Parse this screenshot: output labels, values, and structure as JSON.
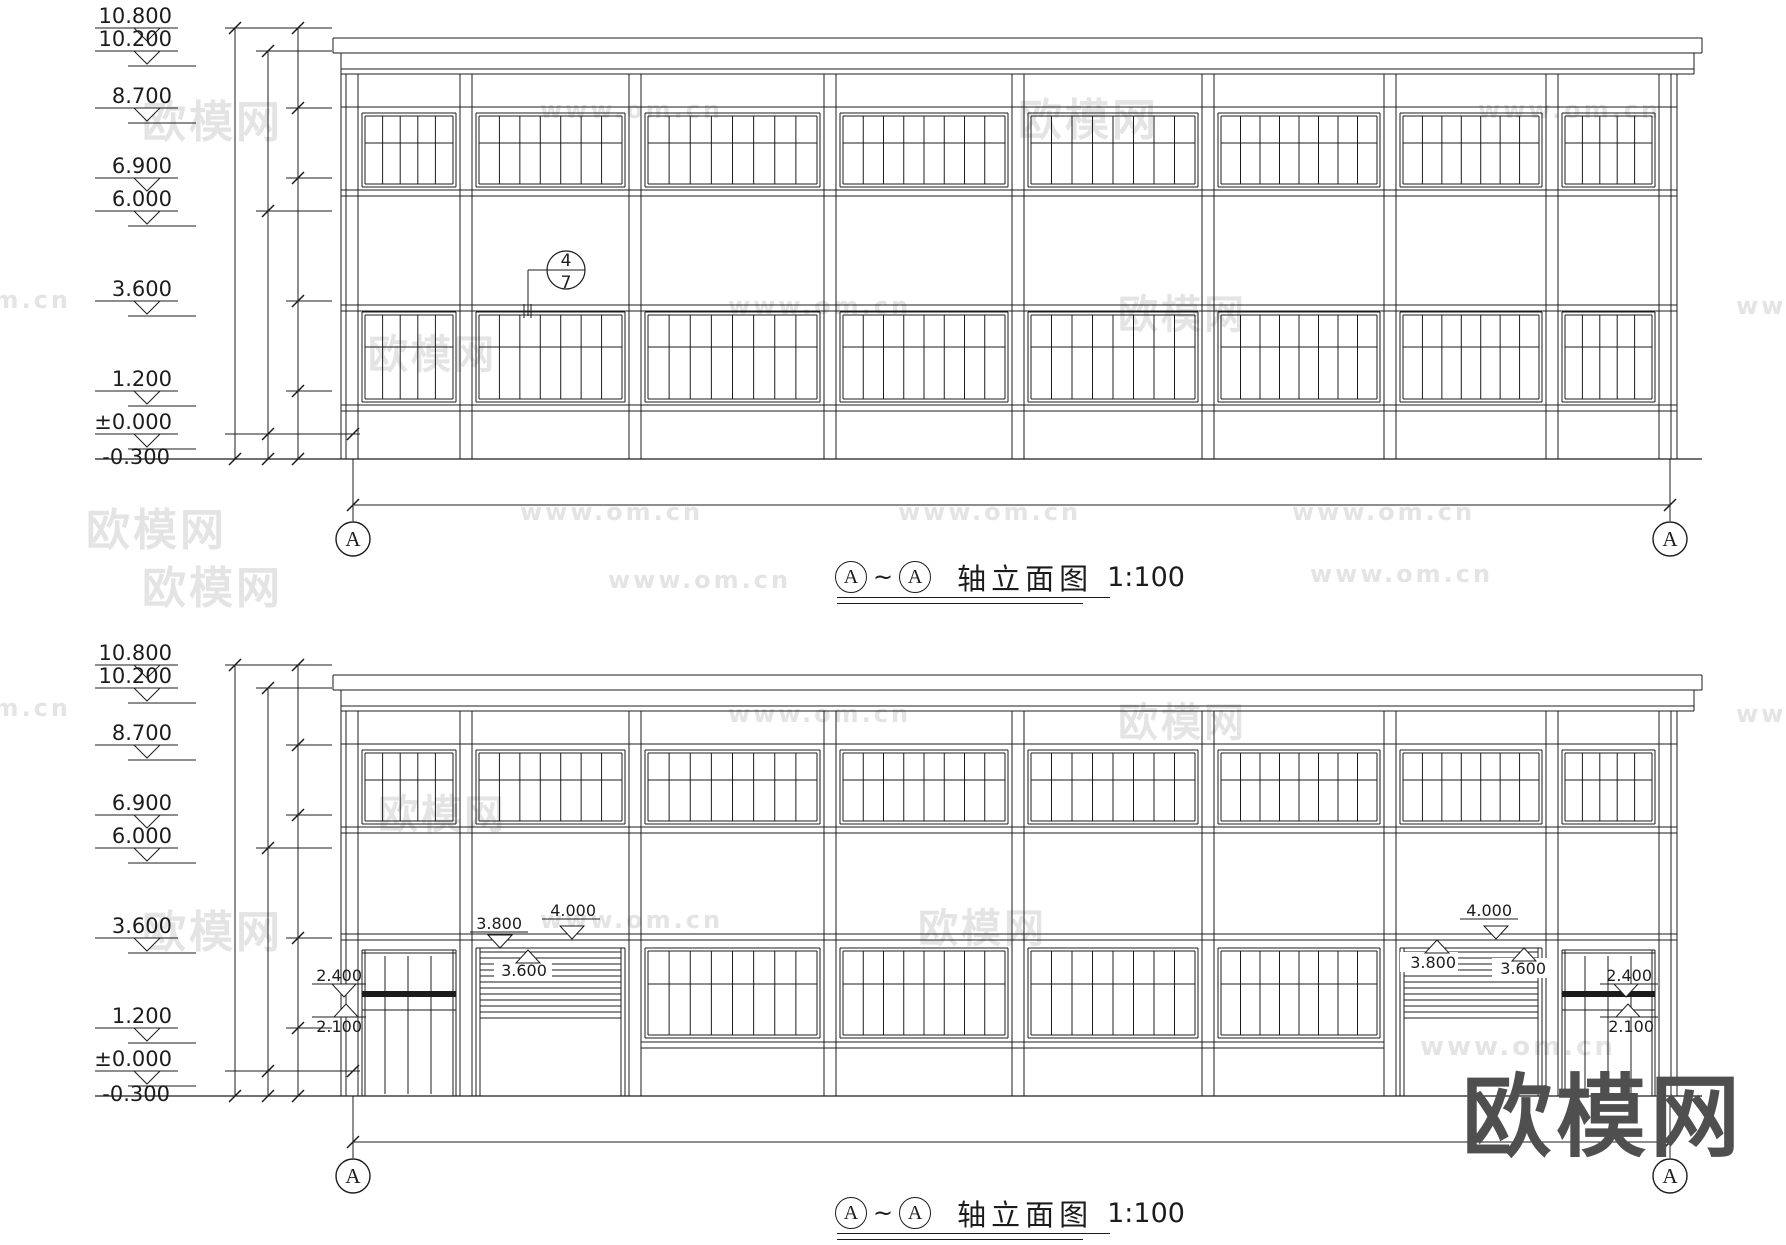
{
  "drawing": {
    "title_row": {
      "axis_a": "A",
      "separator": "~",
      "name": "轴立面图",
      "scale": "1:100"
    },
    "levels": [
      "10.800",
      "10.200",
      "8.700",
      "6.900",
      "6.000",
      "3.600",
      "1.200",
      "±0.000",
      "-0.300"
    ],
    "axis_bubble": "A",
    "detail_callout": {
      "top": "4",
      "bottom": "7"
    },
    "door_annotations": {
      "head": "2.400",
      "transom": "2.100"
    },
    "shutter_annotations": {
      "head": "3.800",
      "opening": "4.000",
      "curtain": "3.600"
    }
  },
  "watermarks": [
    {
      "text": "欧模网",
      "x": 142,
      "y": 86,
      "size": 44,
      "cls": "wm-light"
    },
    {
      "text": "www.om.cn",
      "x": 540,
      "y": 96,
      "size": 24,
      "cls": "wm-light"
    },
    {
      "text": "欧模网",
      "x": 1018,
      "y": 84,
      "size": 44,
      "cls": "wm-light"
    },
    {
      "text": "www.om.cn",
      "x": 1478,
      "y": 96,
      "size": 24,
      "cls": "wm-light"
    },
    {
      "text": "om.cn",
      "x": -26,
      "y": 286,
      "size": 24,
      "cls": "wm-light"
    },
    {
      "text": "欧模网",
      "x": 368,
      "y": 322,
      "size": 40,
      "cls": "wm-light"
    },
    {
      "text": "www.om.cn",
      "x": 728,
      "y": 292,
      "size": 24,
      "cls": "wm-light"
    },
    {
      "text": "欧模网",
      "x": 1118,
      "y": 282,
      "size": 40,
      "cls": "wm-light"
    },
    {
      "text": "www.",
      "x": 1736,
      "y": 292,
      "size": 24,
      "cls": "wm-light"
    },
    {
      "text": "欧模网",
      "x": 86,
      "y": 494,
      "size": 44,
      "cls": "wm-light"
    },
    {
      "text": "www.om.cn",
      "x": 520,
      "y": 498,
      "size": 24,
      "cls": "wm-light"
    },
    {
      "text": "www.om.cn",
      "x": 898,
      "y": 498,
      "size": 24,
      "cls": "wm-light"
    },
    {
      "text": "www.om.cn",
      "x": 1292,
      "y": 498,
      "size": 24,
      "cls": "wm-light"
    },
    {
      "text": "欧模网",
      "x": 142,
      "y": 552,
      "size": 44,
      "cls": "wm-light"
    },
    {
      "text": "www.om.cn",
      "x": 608,
      "y": 566,
      "size": 24,
      "cls": "wm-light"
    },
    {
      "text": "www.om.cn",
      "x": 1310,
      "y": 560,
      "size": 24,
      "cls": "wm-light"
    },
    {
      "text": "om.cn",
      "x": -26,
      "y": 694,
      "size": 24,
      "cls": "wm-light"
    },
    {
      "text": "www.om.cn",
      "x": 728,
      "y": 700,
      "size": 24,
      "cls": "wm-light"
    },
    {
      "text": "欧模网",
      "x": 1118,
      "y": 690,
      "size": 40,
      "cls": "wm-light"
    },
    {
      "text": "www.",
      "x": 1736,
      "y": 700,
      "size": 24,
      "cls": "wm-light"
    },
    {
      "text": "欧模网",
      "x": 378,
      "y": 782,
      "size": 40,
      "cls": "wm-light"
    },
    {
      "text": "欧模网",
      "x": 142,
      "y": 896,
      "size": 44,
      "cls": "wm-light"
    },
    {
      "text": "www.om.cn",
      "x": 540,
      "y": 906,
      "size": 24,
      "cls": "wm-light"
    },
    {
      "text": "欧模网",
      "x": 918,
      "y": 896,
      "size": 40,
      "cls": "wm-light"
    },
    {
      "text": "www.om.cn",
      "x": 1420,
      "y": 1032,
      "size": 26,
      "cls": "wm-light"
    },
    {
      "text": "欧模网",
      "x": 1462,
      "y": 1044,
      "size": 90,
      "cls": "wm-dark"
    }
  ]
}
